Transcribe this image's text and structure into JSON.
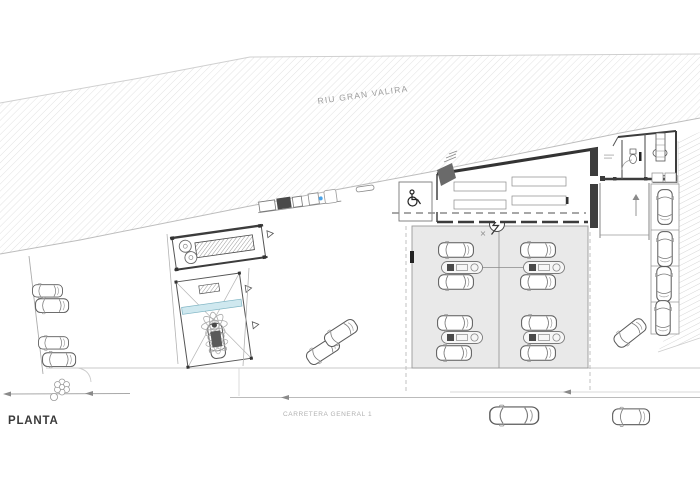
{
  "drawing": {
    "title": "PLANTA",
    "river_label": "RIU GRAN VALIRA",
    "road_label": "CARRETERA GENERAL 1"
  },
  "colors": {
    "paper": "#ffffff",
    "river_hatch_line": "#e2e2e2",
    "embankment_hatch_line": "#d6d6d6",
    "canopy_fill": "#e9e9e9",
    "wash_water_bar": "#cfe8ef",
    "equipment_accent_blue": "#4aa3e8",
    "wall_dark": "#3c3c3c",
    "line_gray": "#9a9a9a",
    "label_gray": "#9c9c9c"
  },
  "features": {
    "fuel_islands": 4,
    "canopy_cars": 8,
    "right_parking_cars": 4,
    "street_parking_cars": 4,
    "road_cars": 2,
    "queue_cars": 3
  }
}
